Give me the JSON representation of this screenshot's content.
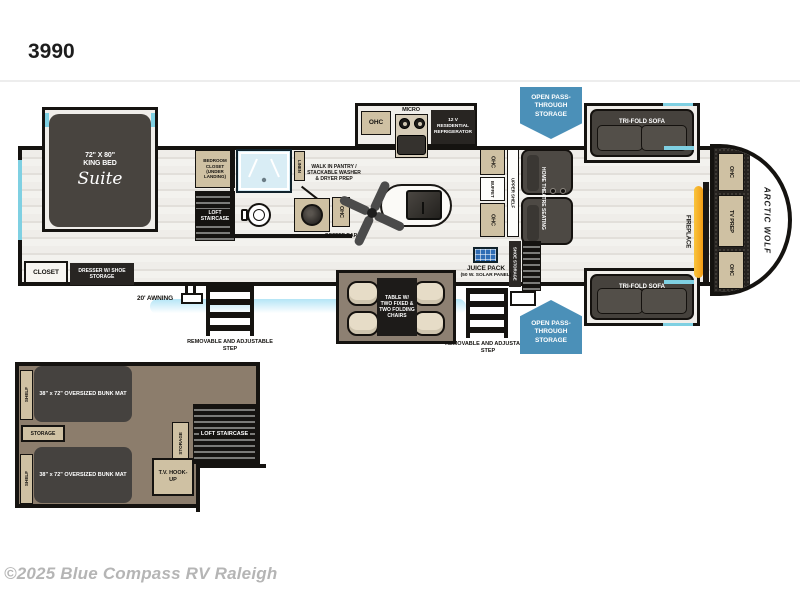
{
  "page": {
    "model": "3990",
    "copyright": "©2025 Blue Compass RV Raleigh"
  },
  "colors": {
    "banner_blue": "#4b90b8",
    "wall_black": "#151310",
    "cabinet_tan": "#cfc1a3",
    "furniture_dark": "#46423d",
    "loft_floor": "#8c7d6c",
    "window_cyan": "#7fd0e2",
    "fireplace_orange": "#f29b14",
    "solar_blue": "#2f6db5"
  },
  "floorplan": {
    "bedroom": {
      "bed_size": "72\" X 80\"",
      "bed_type": "KING BED",
      "bed_script": "Suite",
      "closet": "CLOSET",
      "dresser": "DRESSER W/ SHOE STORAGE",
      "bedroom_closet": "BEDROOM CLOSET (UNDER LANDING)",
      "loft_staircase": "LOFT STAIRCASE"
    },
    "bath": {
      "linen": "LINEN",
      "pantry": "WALK IN PANTRY / STACKABLE WASHER & DRYER PREP"
    },
    "kitchen": {
      "ohc": "OHC",
      "micro": "MICRO",
      "fridge": "12 V RESIDENTIAL REFRIGERATOR",
      "coffee_ohc": "OHC",
      "coffee_bar": "COFFEE BAR"
    },
    "dining": {
      "table": "TABLE W/ TWO FIXED & TWO FOLDING CHAIRS"
    },
    "living": {
      "ohc_top": "OHC",
      "buffet": "BUFFET",
      "upper_shelf": "UPPER SHELF",
      "ohc_bottom": "OHC",
      "theatre": "HOME THEATRE SEATING",
      "sofa_top": "TRI-FOLD SOFA",
      "sofa_bottom": "TRI-FOLD SOFA",
      "fireplace": "FIREPLACE",
      "shoe_storage": "SHOE STORAGE"
    },
    "front_cap": {
      "ohc_top": "OHC",
      "tv_prep": "TV PREP",
      "ohc_bottom": "OHC",
      "brand": "ARCTIC WOLF"
    },
    "exterior": {
      "awning": "20' AWNING",
      "step_left": "REMOVABLE AND ADJUSTABLE STEP",
      "step_right": "REMOVABLE AND ADJUSTABLE STEP",
      "juice_title": "JUICE PACK",
      "juice_sub": "(50 W. SOLAR PANEL)",
      "storage_top": "OPEN PASS-THROUGH STORAGE",
      "storage_bottom": "OPEN PASS-THROUGH STORAGE"
    }
  },
  "loft": {
    "bunk_top": "38\" x 72\" OVERSIZED BUNK MAT",
    "bunk_bottom": "38\" x 72\" OVERSIZED BUNK MAT",
    "shelf_top": "SHELF",
    "shelf_bottom": "SHELF",
    "storage_between": "STORAGE",
    "storage_side": "STORAGE",
    "staircase": "LOFT STAIRCASE",
    "tv_hookup": "T.V. HOOK-UP"
  }
}
